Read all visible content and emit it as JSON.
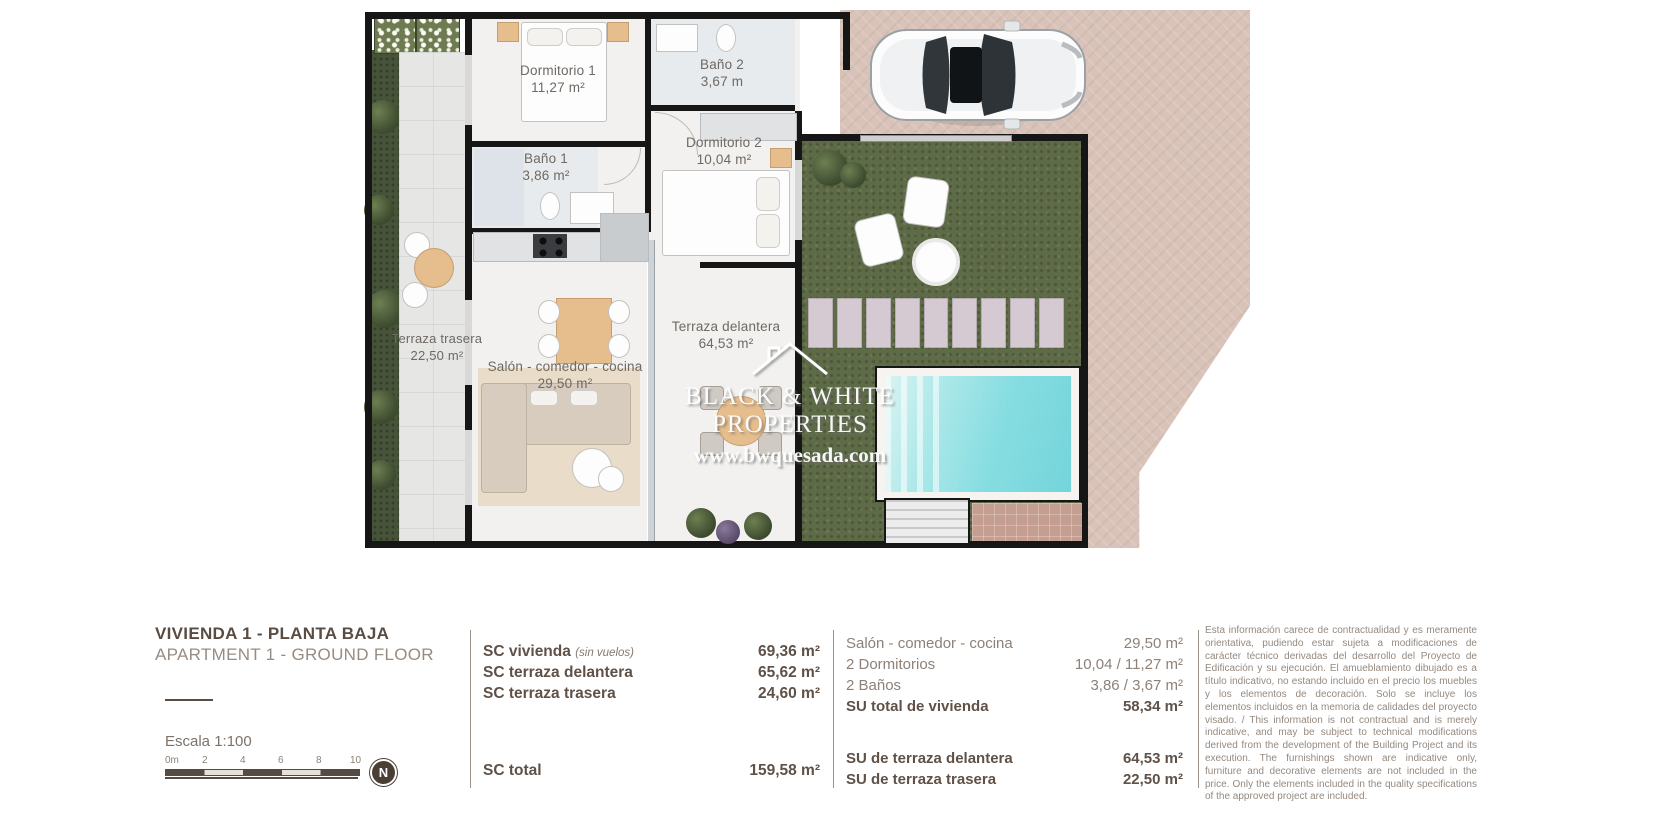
{
  "plan": {
    "rooms": [
      {
        "name": "Dormitorio 1",
        "area": "11,27 m²"
      },
      {
        "name": "Baño 2",
        "area": "3,67 m"
      },
      {
        "name": "Dormitorio 2",
        "area": "10,04 m²"
      },
      {
        "name": "Baño 1",
        "area": "3,86 m²"
      },
      {
        "name": "Terraza trasera",
        "area": "22,50 m²"
      },
      {
        "name": "Salón - comedor - cocina",
        "area": "29,50 m²"
      },
      {
        "name": "Terraza delantera",
        "area": "64,53 m²"
      }
    ],
    "watermark": {
      "line1": "BLACK & WHITE",
      "line2": "PROPERTIES",
      "url": "www.bwquesada.com"
    }
  },
  "footer": {
    "title_es": "VIVIENDA 1 - PLANTA BAJA",
    "title_en": "APARTMENT 1 - GROUND FLOOR",
    "scale_label": "Escala  1:100",
    "scale_ticks": [
      "0m",
      "2",
      "4",
      "6",
      "8",
      "10"
    ],
    "compass_label": "N",
    "sc_rows": [
      {
        "label": "SC vivienda",
        "note": "(sin vuelos)",
        "value": "69,36 m²"
      },
      {
        "label": "SC terraza delantera",
        "value": "65,62 m²"
      },
      {
        "label": "SC terraza trasera",
        "value": "24,60 m²"
      }
    ],
    "sc_total": {
      "label": "SC total",
      "value": "159,58 m²"
    },
    "su_rows": [
      {
        "label": "Salón - comedor - cocina",
        "value": "29,50 m²"
      },
      {
        "label": "2 Dormitorios",
        "value": "10,04 / 11,27 m²"
      },
      {
        "label": "2 Baños",
        "value": "3,86 / 3,67 m²"
      },
      {
        "label": "SU total de vivienda",
        "value": "58,34 m²"
      }
    ],
    "su_terraces": [
      {
        "label": "SU de terraza delantera",
        "value": "64,53 m²"
      },
      {
        "label": "SU de terraza trasera",
        "value": "22,50 m²"
      }
    ],
    "disclaimer_es": "Esta información carece de contractualidad y es meramente orientativa, pudiendo estar sujeta a modificaciones de carácter técnico derivadas del desarrollo del Proyecto de Edificación y su ejecución. El amueblamiento dibujado es a título indicativo, no estando incluido en el precio los muebles y los elementos de decoración. Solo se incluye los elementos incluidos en la memoria de calidades del proyecto visado. /",
    "disclaimer_en": "This information is not contractual and is merely indicative, and may be subject to technical modifications derived from the development of the Building Project and its execution. The furnishings shown are indicative only, furniture and decorative elements are not included in the price. Only the elements included in the quality specifications of the approved project are included."
  },
  "colors": {
    "wall": "#161616",
    "paving": "#d9c3b9",
    "garden": "#5e6b47",
    "pool": "#74d5da",
    "accent_text": "#584c43",
    "muted_text": "#8d8178"
  }
}
